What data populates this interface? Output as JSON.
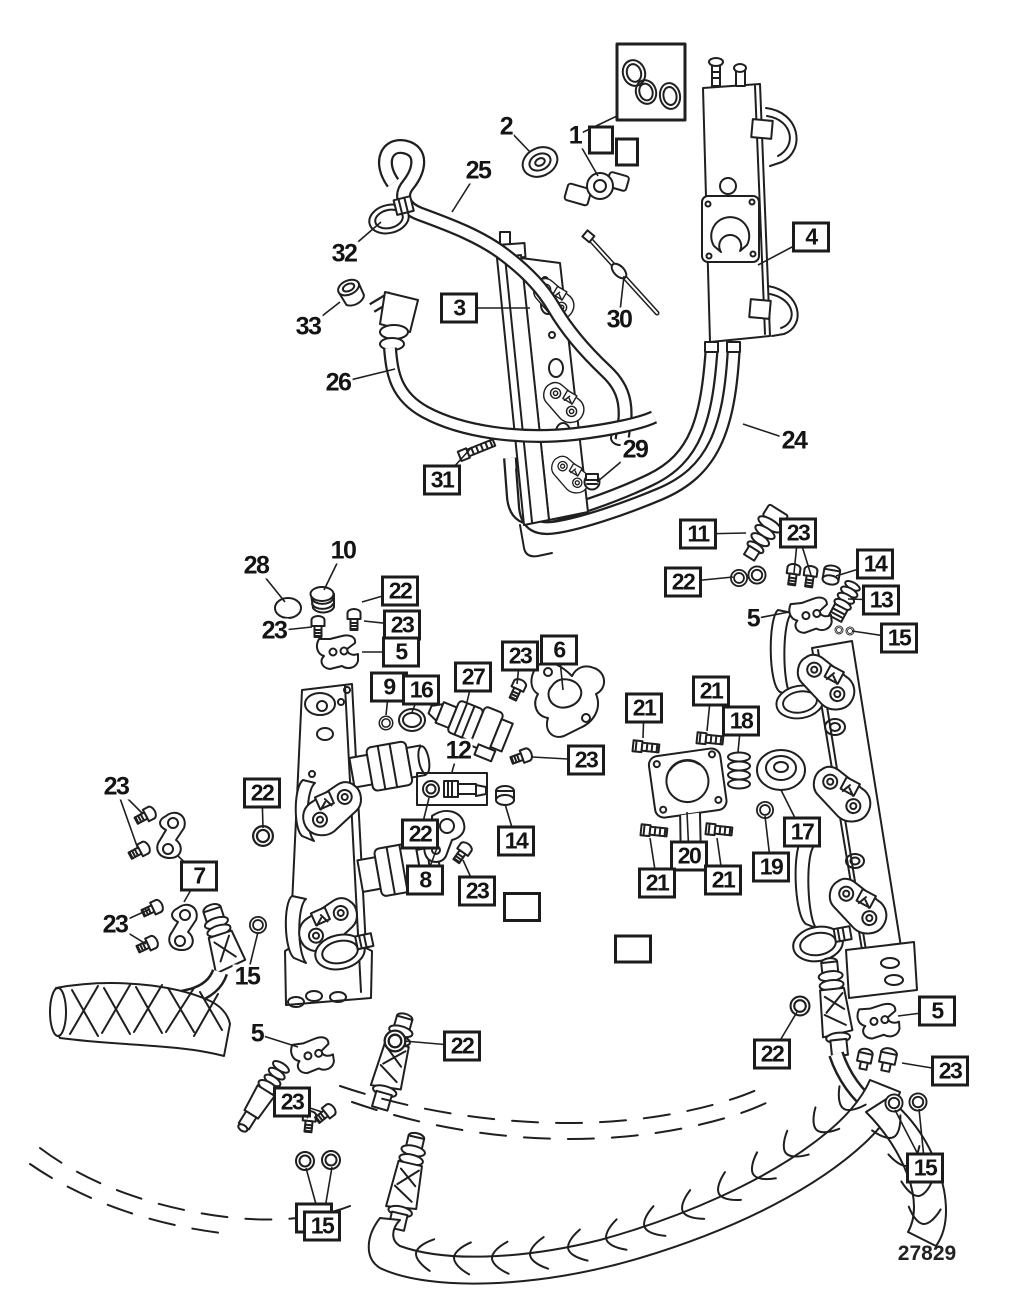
{
  "diagram": {
    "number": "27829"
  },
  "colors": {
    "ink": "#1f1f1f",
    "background": "#ffffff"
  },
  "legend": {
    "oring_kit_box": "box containing three o-rings, upper right"
  },
  "callouts": [
    {
      "label": "2",
      "x": 506,
      "y": 127,
      "boxed": false,
      "leaders": [
        [
          530,
          152
        ]
      ]
    },
    {
      "label": "1",
      "x": 575,
      "y": 136,
      "boxed": false,
      "leaders": [
        [
          598,
          176
        ],
        [
          617,
          116
        ]
      ]
    },
    {
      "label": "25",
      "x": 478,
      "y": 171,
      "boxed": false,
      "leaders": [
        [
          452,
          212
        ]
      ]
    },
    {
      "label": "32",
      "x": 344,
      "y": 254,
      "boxed": false,
      "leaders": [
        [
          381,
          222
        ]
      ]
    },
    {
      "label": "33",
      "x": 308,
      "y": 327,
      "boxed": false,
      "leaders": [
        [
          340,
          302
        ]
      ]
    },
    {
      "label": "3",
      "x": 459,
      "y": 308,
      "boxed": true,
      "leaders": [
        [
          530,
          308
        ]
      ]
    },
    {
      "label": "4",
      "x": 811,
      "y": 237,
      "boxed": true,
      "leaders": [
        [
          758,
          265
        ]
      ]
    },
    {
      "label": "26",
      "x": 338,
      "y": 383,
      "boxed": false,
      "leaders": [
        [
          395,
          369
        ]
      ]
    },
    {
      "label": "30",
      "x": 619,
      "y": 320,
      "boxed": false,
      "leaders": [
        [
          624,
          276
        ]
      ]
    },
    {
      "label": "31",
      "x": 442,
      "y": 480,
      "boxed": true,
      "leaders": [
        [
          472,
          447
        ]
      ]
    },
    {
      "label": "29",
      "x": 635,
      "y": 450,
      "boxed": false,
      "leaders": [
        [
          597,
          482
        ]
      ]
    },
    {
      "label": "24",
      "x": 794,
      "y": 441,
      "boxed": false,
      "leaders": [
        [
          743,
          424
        ]
      ]
    },
    {
      "label": "11",
      "x": 698,
      "y": 534,
      "boxed": true,
      "leaders": [
        [
          746,
          533
        ]
      ]
    },
    {
      "label": "23",
      "x": 798,
      "y": 533,
      "boxed": true,
      "leaders": [
        [
          794,
          573
        ],
        [
          811,
          575
        ]
      ]
    },
    {
      "label": "14",
      "x": 875,
      "y": 564,
      "boxed": true,
      "leaders": [
        [
          836,
          576
        ]
      ]
    },
    {
      "label": "22",
      "x": 683,
      "y": 582,
      "boxed": true,
      "leaders": [
        [
          733,
          577
        ]
      ]
    },
    {
      "label": "13",
      "x": 881,
      "y": 600,
      "boxed": true,
      "leaders": [
        [
          848,
          599
        ]
      ]
    },
    {
      "label": "5",
      "x": 753,
      "y": 619,
      "boxed": false,
      "leaders": [
        [
          789,
          612
        ]
      ]
    },
    {
      "label": "15",
      "x": 899,
      "y": 638,
      "boxed": true,
      "leaders": [
        [
          852,
          631
        ]
      ]
    },
    {
      "label": "28",
      "x": 256,
      "y": 566,
      "boxed": false,
      "leaders": [
        [
          285,
          602
        ]
      ]
    },
    {
      "label": "10",
      "x": 343,
      "y": 551,
      "boxed": false,
      "leaders": [
        [
          324,
          590
        ]
      ]
    },
    {
      "label": "22",
      "x": 400,
      "y": 591,
      "boxed": true,
      "leaders": [
        [
          362,
          602
        ]
      ]
    },
    {
      "label": "23",
      "x": 274,
      "y": 631,
      "boxed": false,
      "leaders": [
        [
          312,
          627
        ]
      ]
    },
    {
      "label": "23",
      "x": 402,
      "y": 625,
      "boxed": true,
      "leaders": [
        [
          364,
          621
        ]
      ]
    },
    {
      "label": "5",
      "x": 401,
      "y": 652,
      "boxed": true,
      "leaders": [
        [
          362,
          652
        ]
      ]
    },
    {
      "label": "9",
      "x": 389,
      "y": 687,
      "boxed": true,
      "leaders": [
        [
          386,
          715
        ]
      ]
    },
    {
      "label": "16",
      "x": 421,
      "y": 690,
      "boxed": true,
      "leaders": [
        [
          412,
          712
        ]
      ]
    },
    {
      "label": "27",
      "x": 473,
      "y": 677,
      "boxed": true,
      "leaders": [
        [
          467,
          702
        ]
      ]
    },
    {
      "label": "23",
      "x": 520,
      "y": 656,
      "boxed": true,
      "leaders": [
        [
          517,
          684
        ]
      ]
    },
    {
      "label": "6",
      "x": 559,
      "y": 650,
      "boxed": true,
      "leaders": [
        [
          563,
          690
        ]
      ]
    },
    {
      "label": "23",
      "x": 586,
      "y": 760,
      "boxed": true,
      "leaders": [
        [
          532,
          757
        ]
      ]
    },
    {
      "label": "12",
      "x": 458,
      "y": 751,
      "boxed": false,
      "leaders": [
        [
          452,
          772
        ]
      ]
    },
    {
      "label": "21",
      "x": 644,
      "y": 708,
      "boxed": true,
      "leaders": [
        [
          643,
          738
        ]
      ]
    },
    {
      "label": "21",
      "x": 711,
      "y": 691,
      "boxed": true,
      "leaders": [
        [
          707,
          731
        ]
      ]
    },
    {
      "label": "18",
      "x": 741,
      "y": 721,
      "boxed": true,
      "leaders": [
        [
          738,
          752
        ]
      ]
    },
    {
      "label": "14",
      "x": 516,
      "y": 841,
      "boxed": true,
      "leaders": [
        [
          505,
          804
        ]
      ]
    },
    {
      "label": "22",
      "x": 420,
      "y": 834,
      "boxed": true,
      "leaders": [
        [
          429,
          798
        ]
      ]
    },
    {
      "label": "8",
      "x": 425,
      "y": 880,
      "boxed": true,
      "leaders": [
        [
          437,
          848
        ]
      ]
    },
    {
      "label": "23",
      "x": 477,
      "y": 891,
      "boxed": true,
      "leaders": [
        [
          463,
          860
        ]
      ]
    },
    {
      "label": "20",
      "x": 689,
      "y": 856,
      "boxed": true,
      "leaders": [
        [
          687,
          812
        ]
      ]
    },
    {
      "label": "21",
      "x": 657,
      "y": 883,
      "boxed": true,
      "leaders": [
        [
          650,
          838
        ]
      ]
    },
    {
      "label": "21",
      "x": 723,
      "y": 880,
      "boxed": true,
      "leaders": [
        [
          717,
          838
        ]
      ]
    },
    {
      "label": "17",
      "x": 802,
      "y": 832,
      "boxed": true,
      "leaders": [
        [
          781,
          790
        ]
      ]
    },
    {
      "label": "19",
      "x": 771,
      "y": 867,
      "boxed": true,
      "leaders": [
        [
          765,
          816
        ]
      ]
    },
    {
      "label": "23",
      "x": 116,
      "y": 787,
      "boxed": false,
      "leaders": [
        [
          143,
          814
        ],
        [
          138,
          849
        ]
      ]
    },
    {
      "label": "22",
      "x": 262,
      "y": 793,
      "boxed": true,
      "leaders": [
        [
          263,
          828
        ]
      ]
    },
    {
      "label": "7",
      "x": 199,
      "y": 876,
      "boxed": true,
      "leaders": [
        [
          178,
          856
        ],
        [
          184,
          902
        ]
      ]
    },
    {
      "label": "23",
      "x": 115,
      "y": 925,
      "boxed": false,
      "leaders": [
        [
          150,
          909
        ],
        [
          146,
          944
        ]
      ]
    },
    {
      "label": "15",
      "x": 247,
      "y": 977,
      "boxed": false,
      "leaders": [
        [
          258,
          932
        ]
      ]
    },
    {
      "label": "5",
      "x": 257,
      "y": 1034,
      "boxed": false,
      "leaders": [
        [
          298,
          1047
        ]
      ]
    },
    {
      "label": "22",
      "x": 462,
      "y": 1046,
      "boxed": true,
      "leaders": [
        [
          404,
          1041
        ]
      ]
    },
    {
      "label": "23",
      "x": 292,
      "y": 1102,
      "boxed": true,
      "leaders": [
        [
          308,
          1118
        ],
        [
          322,
          1112
        ]
      ]
    },
    {
      "label": "22",
      "x": 772,
      "y": 1054,
      "boxed": true,
      "leaders": [
        [
          797,
          1012
        ]
      ]
    },
    {
      "label": "5",
      "x": 937,
      "y": 1011,
      "boxed": true,
      "leaders": [
        [
          898,
          1016
        ]
      ]
    },
    {
      "label": "23",
      "x": 950,
      "y": 1071,
      "boxed": true,
      "leaders": [
        [
          902,
          1063
        ]
      ]
    },
    {
      "label": "15",
      "x": 925,
      "y": 1168,
      "boxed": true,
      "leaders": [
        [
          895,
          1110
        ],
        [
          919,
          1109
        ]
      ]
    },
    {
      "label": "15",
      "x": 322,
      "y": 1226,
      "boxed": true,
      "double": true,
      "leaders": [
        [
          306,
          1168
        ],
        [
          332,
          1167
        ]
      ]
    },
    {
      "label": "",
      "x": 601,
      "y": 140,
      "boxed": true,
      "w": 12,
      "h": 21
    },
    {
      "label": "",
      "x": 627,
      "y": 152,
      "boxed": true,
      "w": 10,
      "h": 21
    },
    {
      "label": "",
      "x": 522,
      "y": 907,
      "boxed": true,
      "w": 24,
      "h": 22
    },
    {
      "label": "",
      "x": 633,
      "y": 949,
      "boxed": true,
      "w": 24,
      "h": 21
    }
  ]
}
